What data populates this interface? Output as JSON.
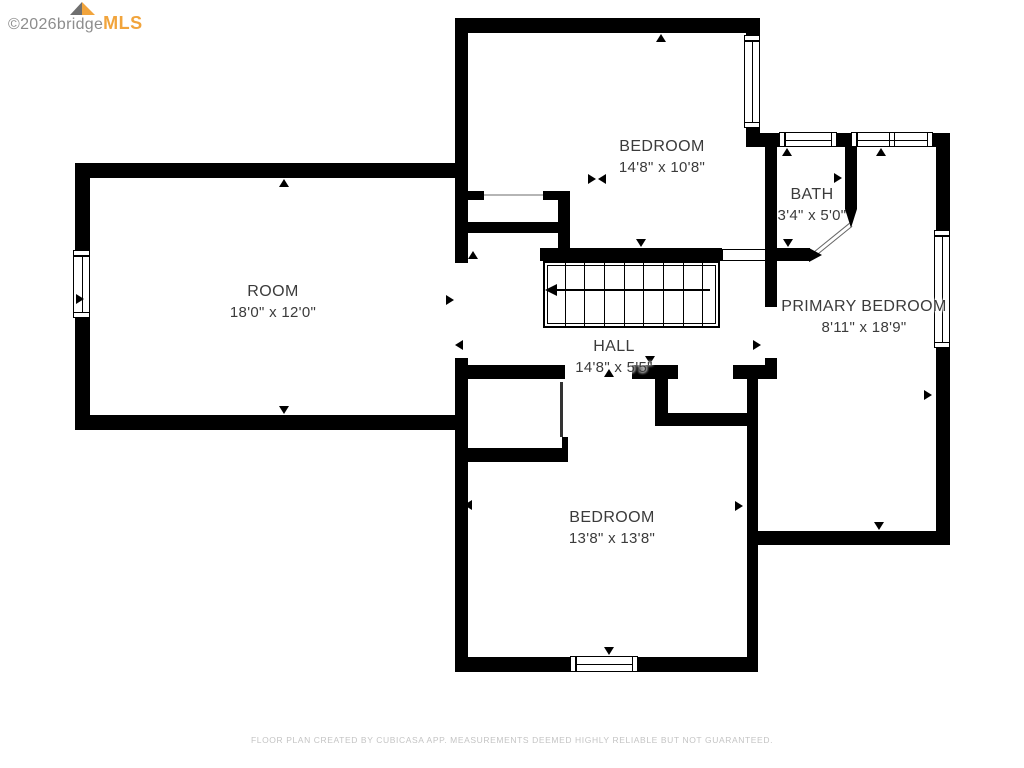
{
  "branding": {
    "copyright": "©2026",
    "name_gray": "bridge",
    "name_orange": "MLS"
  },
  "footer": {
    "disclaimer": "FLOOR PLAN CREATED BY CUBICASA APP. MEASUREMENTS DEEMED HIGHLY RELIABLE BUT NOT GUARANTEED."
  },
  "colors": {
    "wall": "#000000",
    "label_text": "#3b3b3b",
    "logo_gray": "#8d8d8d",
    "logo_orange": "#f1a43c",
    "disclaimer_text": "#c4c4c4",
    "background": "#ffffff"
  },
  "rooms": [
    {
      "id": "bedroom-top",
      "name": "BEDROOM",
      "dimensions": "14'8\" x 10'8\"",
      "cx": 662,
      "cy": 136,
      "layer": "over"
    },
    {
      "id": "bath",
      "name": "BATH",
      "dimensions": "3'4\" x 5'0\"",
      "cx": 812,
      "cy": 184,
      "layer": "under"
    },
    {
      "id": "room",
      "name": "ROOM",
      "dimensions": "18'0\" x 12'0\"",
      "cx": 273,
      "cy": 281,
      "layer": "over"
    },
    {
      "id": "primary-bedroom",
      "name": "PRIMARY BEDROOM",
      "dimensions": "8'11\" x 18'9\"",
      "cx": 864,
      "cy": 296,
      "layer": "over"
    },
    {
      "id": "hall",
      "name": "HALL",
      "dimensions": "14'8\" x 5'5\"",
      "cx": 614,
      "cy": 336,
      "layer": "over"
    },
    {
      "id": "bedroom-bottom",
      "name": "BEDROOM",
      "dimensions": "13'8\" x 13'8\"",
      "cx": 612,
      "cy": 507,
      "layer": "over"
    }
  ],
  "floorplan": {
    "walls": [
      [
        455,
        18,
        305,
        15
      ],
      [
        455,
        18,
        13,
        245
      ],
      [
        746,
        33,
        14,
        114
      ],
      [
        746,
        133,
        204,
        14
      ],
      [
        936,
        147,
        14,
        384
      ],
      [
        765,
        147,
        12,
        160
      ],
      [
        845,
        147,
        12,
        62
      ],
      [
        765,
        248,
        45,
        13
      ],
      [
        540,
        248,
        182,
        13
      ],
      [
        455,
        365,
        110,
        14
      ],
      [
        632,
        365,
        46,
        14
      ],
      [
        733,
        365,
        44,
        14
      ],
      [
        765,
        358,
        12,
        9
      ],
      [
        747,
        377,
        11,
        295
      ],
      [
        655,
        377,
        13,
        49
      ],
      [
        655,
        413,
        103,
        13
      ],
      [
        747,
        531,
        203,
        14
      ],
      [
        75,
        163,
        388,
        15
      ],
      [
        75,
        163,
        15,
        267
      ],
      [
        75,
        415,
        393,
        15
      ],
      [
        455,
        358,
        13,
        314
      ],
      [
        455,
        657,
        300,
        15
      ],
      [
        455,
        448,
        113,
        14
      ],
      [
        562,
        437,
        6,
        11
      ],
      [
        458,
        191,
        26,
        9
      ],
      [
        543,
        191,
        15,
        9
      ],
      [
        558,
        191,
        12,
        57
      ],
      [
        455,
        222,
        115,
        11
      ]
    ],
    "thin_lines": [
      {
        "x": 484,
        "y": 194,
        "w": 59,
        "h": 2,
        "color": "#b5b5b5"
      },
      {
        "x": 560,
        "y": 382,
        "w": 3,
        "h": 55,
        "color": "#333333"
      }
    ],
    "windows": [
      {
        "x": 744,
        "y": 35,
        "w": 16,
        "h": 93,
        "orient": "v",
        "split": false
      },
      {
        "x": 779,
        "y": 132,
        "w": 58,
        "h": 15,
        "orient": "h",
        "split": false
      },
      {
        "x": 851,
        "y": 132,
        "w": 82,
        "h": 15,
        "orient": "h",
        "split": true
      },
      {
        "x": 934,
        "y": 230,
        "w": 16,
        "h": 118,
        "orient": "v",
        "split": false
      },
      {
        "x": 73,
        "y": 250,
        "w": 17,
        "h": 68,
        "orient": "v",
        "split": false
      },
      {
        "x": 570,
        "y": 656,
        "w": 68,
        "h": 16,
        "orient": "h",
        "split": false
      }
    ],
    "railing": {
      "x": 722,
      "y": 249,
      "w": 44,
      "h": 12
    },
    "stairs": {
      "x": 543,
      "y": 261,
      "w": 177,
      "h": 67,
      "treads": 8,
      "arrow": {
        "x": 557,
        "y": 289,
        "len": 153,
        "head_x": 545,
        "head_y": 284
      }
    },
    "bath_door": {
      "wedge": {
        "x": 845,
        "y": 209
      },
      "swing": {
        "x": 812,
        "y": 253,
        "len": 48,
        "angle": -39
      },
      "bar_arrow": {
        "x": 809,
        "y": 248
      }
    },
    "markers": [
      {
        "x": 656,
        "y": 34,
        "d": "up"
      },
      {
        "x": 279,
        "y": 179,
        "d": "up"
      },
      {
        "x": 468,
        "y": 251,
        "d": "up"
      },
      {
        "x": 604,
        "y": 369,
        "d": "up"
      },
      {
        "x": 782,
        "y": 148,
        "d": "up"
      },
      {
        "x": 876,
        "y": 148,
        "d": "up"
      },
      {
        "x": 279,
        "y": 406,
        "d": "down"
      },
      {
        "x": 636,
        "y": 239,
        "d": "down"
      },
      {
        "x": 783,
        "y": 239,
        "d": "down"
      },
      {
        "x": 645,
        "y": 356,
        "d": "down"
      },
      {
        "x": 874,
        "y": 522,
        "d": "down"
      },
      {
        "x": 604,
        "y": 647,
        "d": "down"
      },
      {
        "x": 457,
        "y": 172,
        "d": "left"
      },
      {
        "x": 598,
        "y": 174,
        "d": "left"
      },
      {
        "x": 455,
        "y": 340,
        "d": "left"
      },
      {
        "x": 748,
        "y": 392,
        "d": "left"
      },
      {
        "x": 464,
        "y": 500,
        "d": "left"
      },
      {
        "x": 766,
        "y": 173,
        "d": "left"
      },
      {
        "x": 76,
        "y": 294,
        "d": "right"
      },
      {
        "x": 446,
        "y": 295,
        "d": "right"
      },
      {
        "x": 588,
        "y": 174,
        "d": "right"
      },
      {
        "x": 753,
        "y": 340,
        "d": "right"
      },
      {
        "x": 735,
        "y": 501,
        "d": "right"
      },
      {
        "x": 924,
        "y": 390,
        "d": "right"
      },
      {
        "x": 834,
        "y": 173,
        "d": "right"
      }
    ]
  }
}
